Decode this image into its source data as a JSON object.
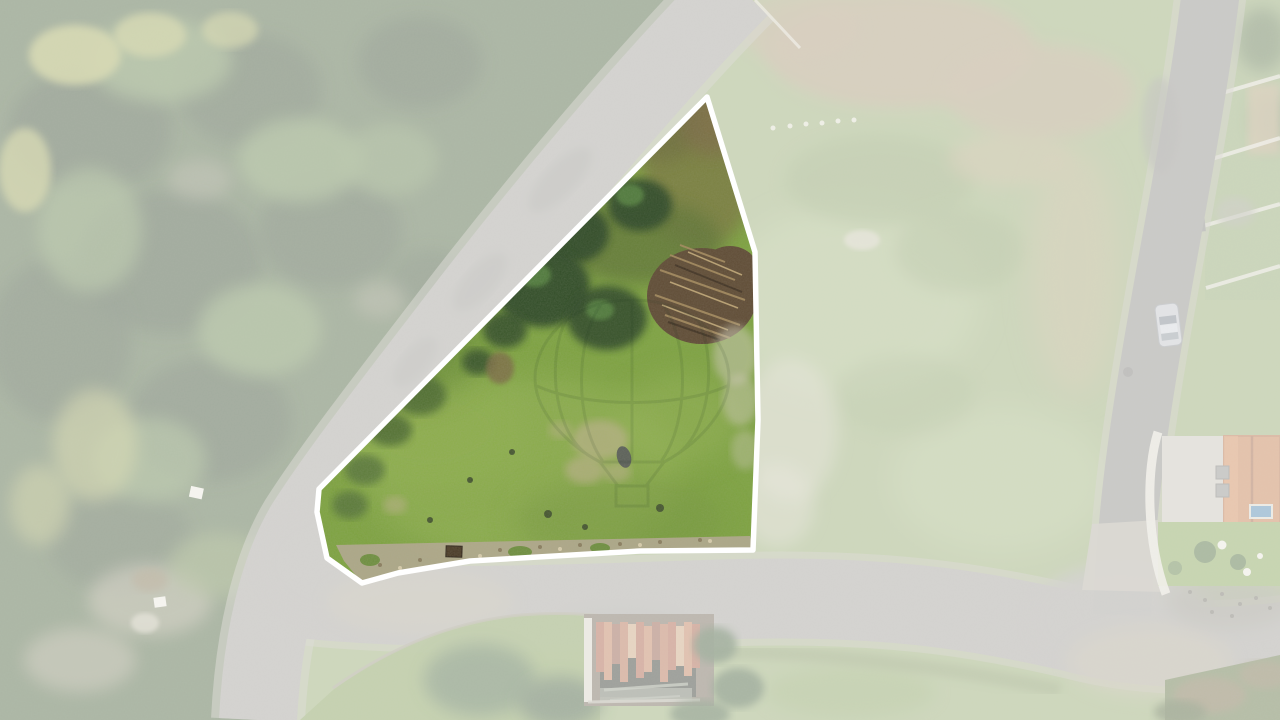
{
  "scene": {
    "type": "aerial-drone-photograph",
    "subject": "Vacant land plot for sale highlighted by a white boundary outline; all surrounding terrain is faded with a white wash",
    "visible_elements": [
      "conifer forest on the left",
      "diagonal asphalt road along the plot's upper-left edge",
      "lower road along the plot's bottom edge",
      "vertical road on the right with a parked car",
      "highlighted green grass parcel with bushes and a wood-debris pile",
      "ruined house with rusted corrugated roof at bottom center",
      "neighbouring house with terracotta tile roof and small pool at right",
      "terraced gardens at top right",
      "faint hot-air-balloon watermark over the parcel"
    ]
  },
  "parcel": {
    "points": "707,97 755,252 758,420 753,550 640,551 470,561 398,573 362,583 327,558 317,512 319,489"
  },
  "overlay": {
    "mask_path": "M0 0H1280V720H0Z M707 97 L755 252 L758 420 L753 550 L640 551 L470 561 L398 573 L362 583 L327 558 L317 512 L319 489 Z"
  },
  "watermark": {
    "name": "hot-air-balloon-watermark",
    "envelope": "M632 300 C566 300 535 345 535 378 C535 414 570 446 600 462 L664 462 C694 446 729 414 729 378 C729 345 698 300 632 300 Z",
    "gores": "M600 306 C576 340 574 420 602 460 M632 300 L632 462 M664 306 C688 340 690 420 662 460 M566 320 C548 355 552 425 584 452 M698 320 C716 355 712 425 680 452",
    "band": "M537 386 C585 408 679 408 727 386",
    "ropes": "M600 462 L618 486 M664 462 L646 486",
    "basket": "M616 486 L648 486 L648 506 L616 506 Z"
  },
  "colors": {
    "field": "#93a86d",
    "field_light": "#aebf8a",
    "field_dark": "#7d9458",
    "field_tan": "#b3a077",
    "dirt": "#ab9674",
    "forest": "#49603a",
    "forest_dark": "#31452a",
    "forest_light": "#6d8a4f",
    "forest_yellow": "#a8ad5a",
    "road": "#a09e97",
    "road_dark": "#8b8a85",
    "road_light": "#b5b2a6",
    "gravel": "#b2a88f",
    "grass": "#7da33f",
    "grass_light": "#97b656",
    "grass_dark": "#5f8230",
    "scrub_olive": "#7a7d41",
    "scrub_brown": "#7c6b44",
    "bush_dark": "#2e4a28",
    "bush_mid": "#4f7a3a",
    "pile_brown": "#5e4a33",
    "pile_stick": "#a58a5c",
    "stone_pale": "#cdc9b4",
    "pale_worn": "#b7b183",
    "roof_orange": "#c47b4a",
    "wall_white": "#e2dfd3",
    "pool_blue": "#4f86b0",
    "car_body": "#c0c4c8",
    "hedge": "#3a5733",
    "outline": "#ffffff",
    "overlay": "#ffffff",
    "watermark": "#1e3520",
    "fade": "0.54",
    "watermark_opacity": "0.10"
  }
}
